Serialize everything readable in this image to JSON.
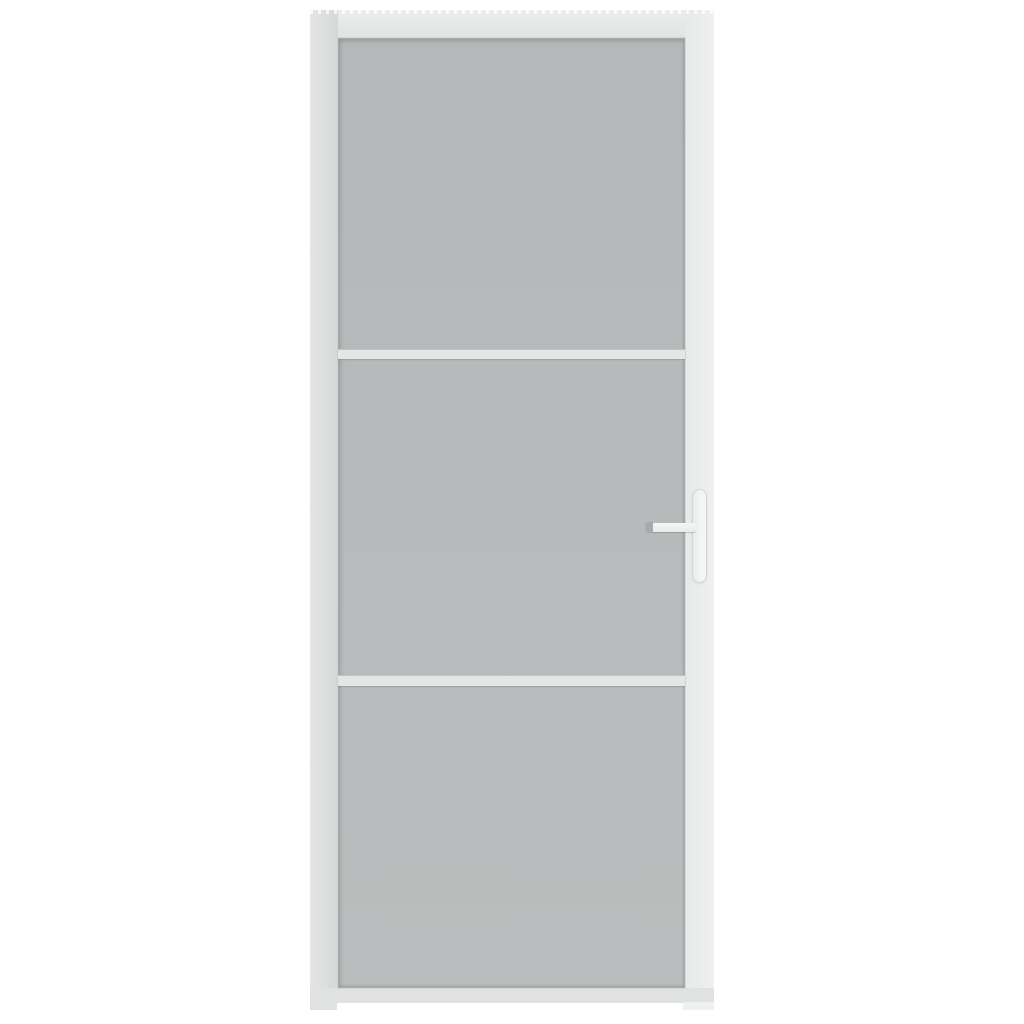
{
  "image": {
    "type": "product-photo",
    "subject": "White interior door with three frosted glass panels, two horizontal divider bars and a white lever handle on the right side",
    "orientation": "front view, centered on plain white background",
    "glass_panel_count": 3,
    "divider_bar_count": 2,
    "handle_side": "right"
  },
  "palette": {
    "bg": "#ffffff",
    "frame": "#e2e4e4",
    "frame_left_outer": "#e4e6e6",
    "frame_left_inner": "#d6d8d8",
    "frame_right_inner": "#e7e9e9",
    "frame_right_outer": "#eff1f1",
    "frame_top_outer": "#eceeee",
    "frame_top_inner": "#e1e3e3",
    "frame_bottom": "#e0e2e2",
    "glass_top": "#b4b8b8",
    "glass_bottom": "#babdbd",
    "glass_edge": "#a6aaaa",
    "divider": "#e5e7e7",
    "divider_shadow": "#bfc3c3",
    "handle_plate": "#f4f6f6",
    "handle_plate_l": "#eaecec",
    "handle_plate_edge": "#d3d7d7",
    "handle_lever": "#f5f7f7",
    "handle_lever_low": "#e9ebeb",
    "handle_cap": "#a7abab"
  }
}
